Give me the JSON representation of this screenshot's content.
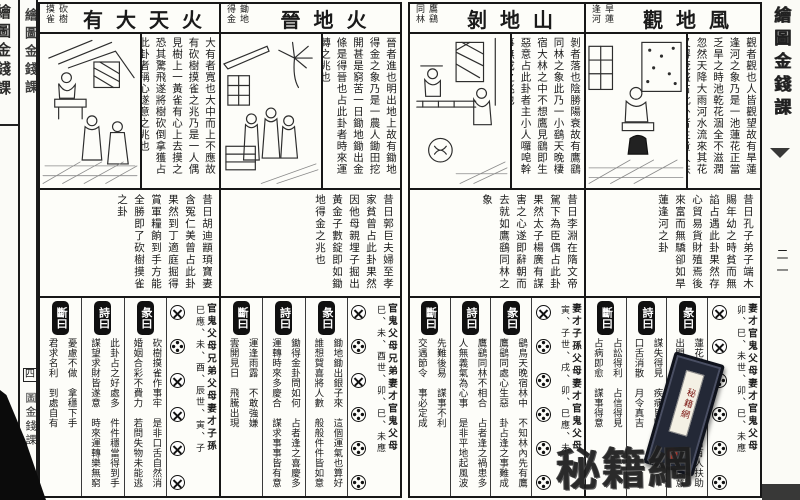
{
  "book": {
    "edge_title": "繪圖金錢課",
    "left_spine_mark": "四",
    "left_spine_lower": "圖金錢課",
    "right_edge_page": "二一",
    "watermark_text": "秘籍網",
    "watermark_label": "秘籍網",
    "ink_color": "#1a1a1a",
    "paper_color": "#fdfdf9"
  },
  "sections": [
    {
      "title": "火天大有",
      "subtitle": "砍樹摸雀",
      "intro": "大有者寬也大中而上不應故有砍樹摸雀之兆乃是一人偶見樹上一黃雀有心上去摸之恐其驚飛遂將樹砍倒拿獲占此卦者稱心遂意之兆也",
      "story": "昔日胡迪顓頊寶妻含冤仁美曾占此卦果然到丁適庭掘得賞軍糧餉到手方能全勝即了砍樹摸雀之卦",
      "duan": {
        "label": "斷曰",
        "col1": "憂慮不做　拿穩下手",
        "col2": "君求名利　到處自有"
      },
      "shi": {
        "label": "詩曰",
        "col1": "此卦占之好處多　件件穩當得到手",
        "col2": "謀望求財皆遂意　時來運轉樂無窮"
      },
      "xiang": {
        "label": "彖曰",
        "col1": "砍樹摸雀作事牢　是非口舌自然消",
        "col2": "婚姻合彩不費力　若問失物未能逃"
      },
      "yao_names": "官鬼父母兄弟父母妻才子孫",
      "yao_branches": "巳應、未、酉、辰世、寅、子",
      "coins": [
        "x",
        "o",
        "x",
        "x",
        "x",
        "x"
      ]
    },
    {
      "title": "火地晉",
      "subtitle": "鋤地得金",
      "intro": "晉者進也明出地上故有鋤地得金之象乃是一農人鋤田挖開甚是窮苦一日鋤地鋤出金條是得晉也占此卦者時來運轉之兆也",
      "story": "昔日郭巨夫婦至孝家貧曾占此卦果然因他母親埋子掘出黃金子數錠即如鋤地得金之兆也",
      "duan": {
        "label": "斷曰",
        "col1": "運逢雨露　不敢強嫌",
        "col2": "雲開見日　飛騰出現"
      },
      "shi": {
        "label": "詩曰",
        "col1": "鋤得金卦問如何　占者逢之喜慶多",
        "col2": "運轉時來多慶合　謀求事事皆有意"
      },
      "xiang": {
        "label": "彖曰",
        "col1": "鋤地鋤出銀子來　這個運氣也算好",
        "col2": "誰想賀喜將人數　般般件件皆如意"
      },
      "yao_names": "官鬼父母兄弟妻才官鬼父母",
      "yao_branches": "巳、未、酉世、卯、巳、未應",
      "coins": [
        "x",
        "o",
        "x",
        "o",
        "o",
        "o"
      ]
    },
    {
      "title": "山地剝",
      "subtitle": "鷹鷂同林",
      "intro": "剝者落也陰勝陽衰故有鷹鷂同林之象此乃一小鷂天晚棲宿大林之中不想鷹見鷂即生惡意占此卦者主小人囉唣幹事無成之兆也",
      "story": "昔日李淵在隋文帝駕下為臣偶占此卦果然太子楊廣有謀害之心遂即辭朝而去就如鷹鷂同林之象",
      "duan": {
        "label": "斷曰",
        "col1": "先難後易　謀事不利",
        "col2": "交遇節令　事必定成"
      },
      "shi": {
        "label": "詩曰",
        "col1": "鷹鷂同林不相合　占者逢之禍患多",
        "col2": "人無義氣為心事　是非平地起風波"
      },
      "xiang": {
        "label": "彖曰",
        "col1": "鷂鳥天晚宿林中　不知林內先有鷹",
        "col2": "鷹鷂同處心生惡　卦占逢之事難成"
      },
      "yao_names": "妻才子孫父母妻才官鬼父母",
      "yao_branches": "寅、子世、戌、卯、巳應、未",
      "coins": [
        "x",
        "o",
        "o",
        "o",
        "o",
        "o"
      ]
    },
    {
      "title": "風地觀",
      "subtitle": "旱蓮逢河",
      "intro": "觀者觀也人皆觀望故有旱蓮逢河之象乃是一池蓮花正當乏旱之時池乾花涸全不滋潤忽然天降大雨河水流來其花又得茂盛占此卦者主貴人扶持之兆也",
      "story": "昔日孔子弟子端木賜年幼之時貧而無諂占遇此卦果然存心貿易貨財殖焉後來富而無驕卻如旱蓮逢河之卦",
      "duan": {
        "label": "斷曰",
        "col1": "占訟得利　占信得見",
        "col2": "占病即愈　謀事得意"
      },
      "shi": {
        "label": "詩曰",
        "col1": "謀失得見　疾病皆除",
        "col2": "口舌消散　月令真吉"
      },
      "xiang": {
        "label": "彖曰",
        "col1": "蓮花旱枯逢河水　凡事自有人扶助",
        "col2": "出門永不受憂愁　生意買賣多得意"
      },
      "yao_names": "妻才官鬼父母妻才官鬼父母",
      "yao_branches": "卯、巳、未世、卯、巳、未應",
      "coins": [
        "x",
        "x",
        "o",
        "o",
        "o",
        "o"
      ]
    }
  ]
}
